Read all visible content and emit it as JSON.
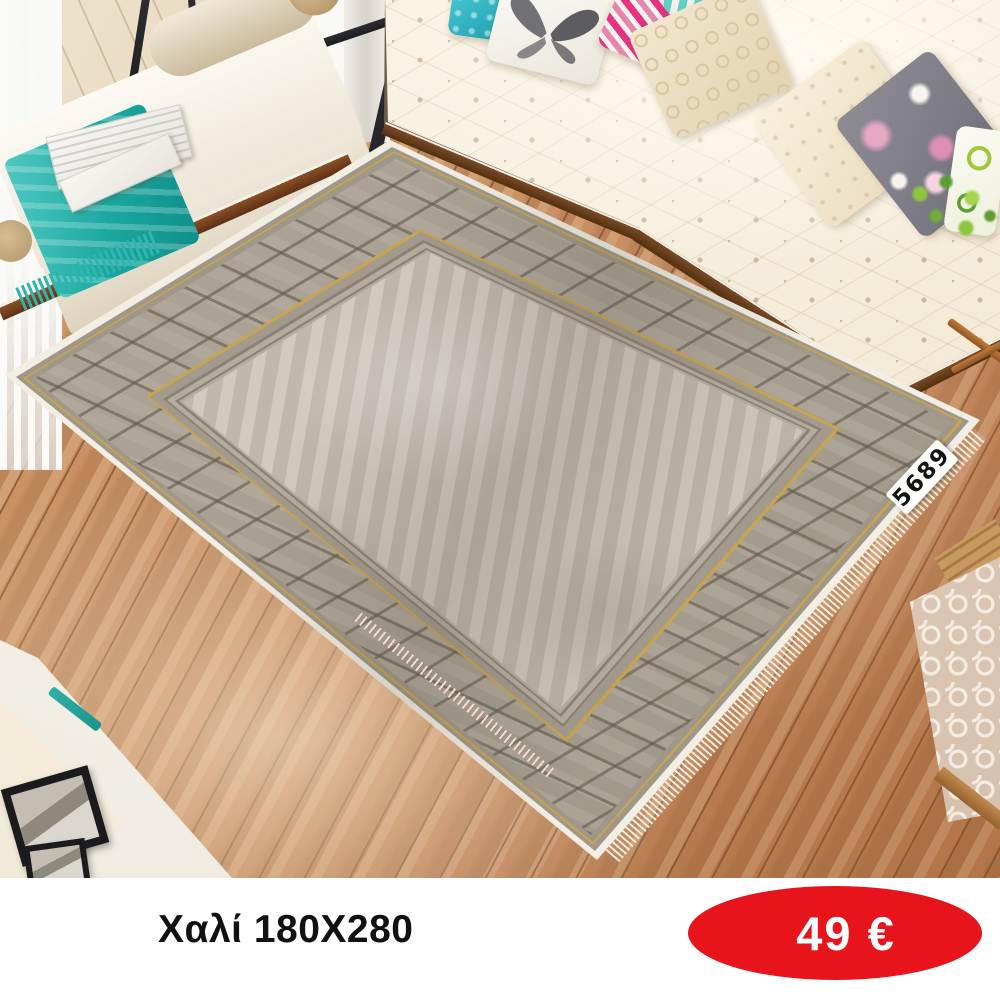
{
  "product": {
    "title": "Χαλί 180X280",
    "price": "49 €",
    "rug_code": "5689"
  },
  "colors": {
    "accent_red": "#e8141b",
    "price_text": "#ffffff",
    "title_text": "#111111",
    "teal": "#2db5ae",
    "wood": "#c4895b",
    "rug_field": "#c5beb2",
    "rug_border": "#a69e90",
    "rug_edge": "#f2eee4",
    "gold": "#c9a44f",
    "sofa_cream": "#f4ead8"
  }
}
